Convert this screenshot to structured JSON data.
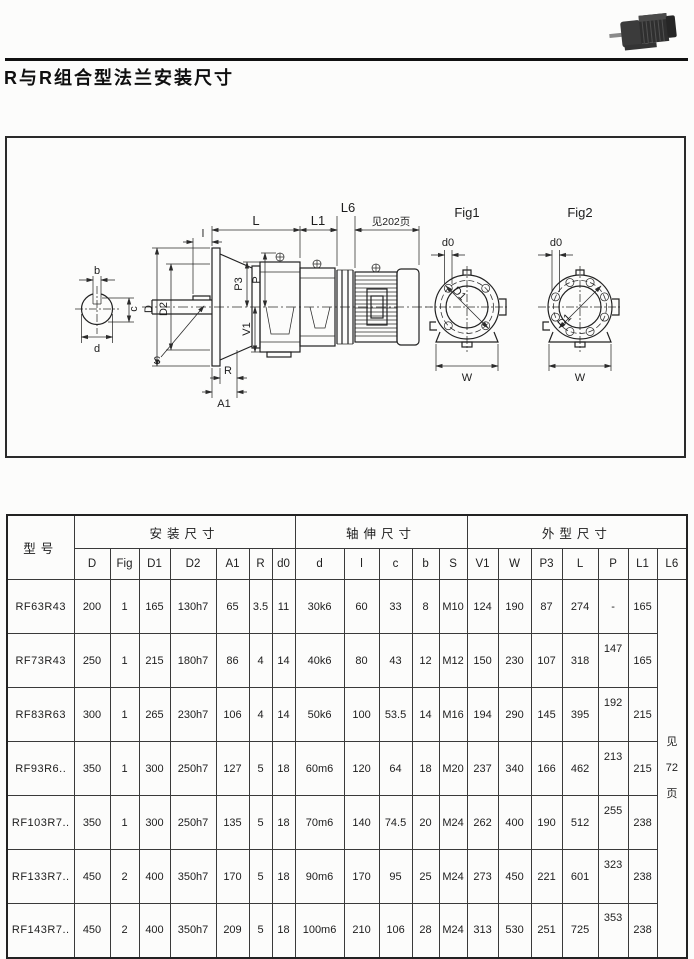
{
  "page": {
    "title": "R与R组合型法兰安装尺寸"
  },
  "colors": {
    "paper": "#fcfcfb",
    "ink": "#1d1d1d",
    "line": "#2b2b2b",
    "rule": "#111111"
  },
  "drawing": {
    "L": "L",
    "L1": "L1",
    "L6": "L6",
    "see_page_202": "见202页",
    "l": "l",
    "b": "b",
    "c": "c",
    "d": "d",
    "D": "D",
    "D2": "D2",
    "D1": "D1",
    "P3": "P3",
    "P": "P",
    "V1": "V1",
    "S": "S",
    "R": "R",
    "A1": "A1",
    "d0": "d0",
    "W": "W",
    "fig1": "Fig1",
    "fig2": "Fig2"
  },
  "table": {
    "model_header": "型号",
    "groups": [
      {
        "label": "安装尺寸"
      },
      {
        "label": "轴伸尺寸"
      },
      {
        "label": "外型尺寸"
      }
    ],
    "columns": [
      "D",
      "Fig",
      "D1",
      "D2",
      "A1",
      "R",
      "d0",
      "d",
      "l",
      "c",
      "b",
      "S",
      "V1",
      "W",
      "P3",
      "L",
      "P",
      "L1",
      "L6"
    ],
    "rows": [
      {
        "model": "RF63R43",
        "values": [
          "200",
          "1",
          "165",
          "130h7",
          "65",
          "3.5",
          "11",
          "30k6",
          "60",
          "33",
          "8",
          "M10",
          "124",
          "190",
          "87",
          "274",
          "-",
          "165"
        ]
      },
      {
        "model": "RF73R43",
        "values": [
          "250",
          "1",
          "215",
          "180h7",
          "86",
          "4",
          "14",
          "40k6",
          "80",
          "43",
          "12",
          "M12",
          "150",
          "230",
          "107",
          "318",
          "147",
          "165"
        ]
      },
      {
        "model": "RF83R63",
        "values": [
          "300",
          "1",
          "265",
          "230h7",
          "106",
          "4",
          "14",
          "50k6",
          "100",
          "53.5",
          "14",
          "M16",
          "194",
          "290",
          "145",
          "395",
          "192",
          "215"
        ]
      },
      {
        "model": "RF93R6..",
        "values": [
          "350",
          "1",
          "300",
          "250h7",
          "127",
          "5",
          "18",
          "60m6",
          "120",
          "64",
          "18",
          "M20",
          "237",
          "340",
          "166",
          "462",
          "213",
          "215"
        ]
      },
      {
        "model": "RF103R7..",
        "values": [
          "350",
          "1",
          "300",
          "250h7",
          "135",
          "5",
          "18",
          "70m6",
          "140",
          "74.5",
          "20",
          "M24",
          "262",
          "400",
          "190",
          "512",
          "255",
          "238"
        ]
      },
      {
        "model": "RF133R7..",
        "values": [
          "450",
          "2",
          "400",
          "350h7",
          "170",
          "5",
          "18",
          "90m6",
          "170",
          "95",
          "25",
          "M24",
          "273",
          "450",
          "221",
          "601",
          "323",
          "238"
        ]
      },
      {
        "model": "RF143R7..",
        "values": [
          "450",
          "2",
          "400",
          "350h7",
          "209",
          "5",
          "18",
          "100m6",
          "210",
          "106",
          "28",
          "M24",
          "313",
          "530",
          "251",
          "725",
          "353",
          "238"
        ]
      }
    ],
    "l6_note_lines": [
      "见",
      "72",
      "页"
    ]
  }
}
